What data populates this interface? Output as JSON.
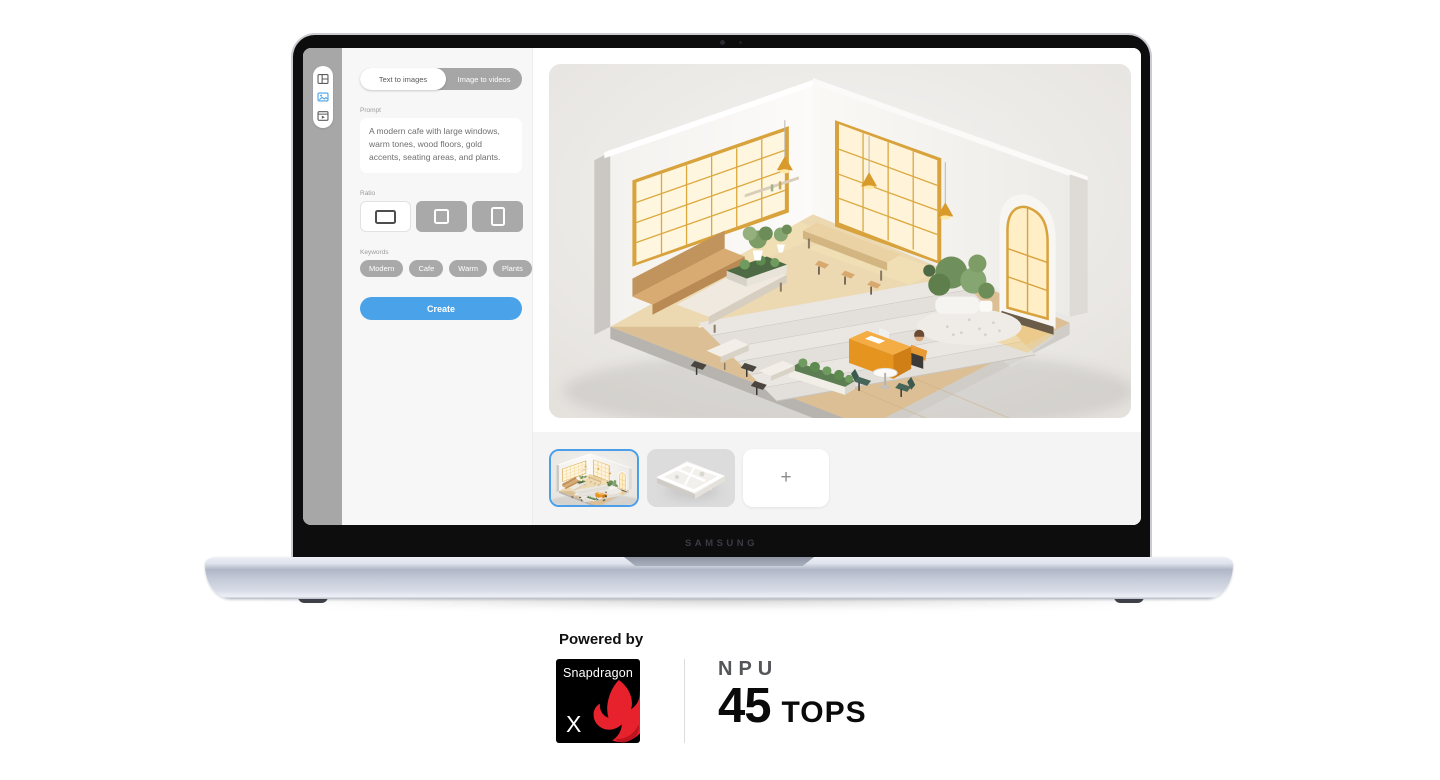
{
  "laptop": {
    "brand": "SAMSUNG"
  },
  "app": {
    "sidebar_icons": [
      {
        "name": "layout-icon"
      },
      {
        "name": "image-icon",
        "active": true
      },
      {
        "name": "video-icon"
      }
    ],
    "tabs": {
      "active": "Text to images",
      "inactive": "Image to videos"
    },
    "prompt": {
      "label": "Prompt",
      "value": "A modern cafe with large windows, warm tones, wood floors, gold accents, seating areas, and plants."
    },
    "ratio": {
      "label": "Ratio",
      "options": [
        "landscape",
        "square",
        "portrait"
      ],
      "selected": "landscape"
    },
    "keywords": {
      "label": "Keywords",
      "chips": [
        "Modern",
        "Cafe",
        "Warm",
        "Plants"
      ]
    },
    "create_label": "Create",
    "thumbnails": {
      "selected_index": 0,
      "add_label": "+"
    }
  },
  "branding": {
    "powered_by": "Powered by",
    "chip_name": "Snapdragon",
    "chip_variant": "X",
    "npu_label": "NPU",
    "tops_value": "45",
    "tops_unit": "TOPS"
  },
  "colors": {
    "accent_blue": "#4aa2e8",
    "snapdragon_red": "#e8222d",
    "window_gold": "#d8a23c",
    "base_silver": "#c5cad8"
  }
}
